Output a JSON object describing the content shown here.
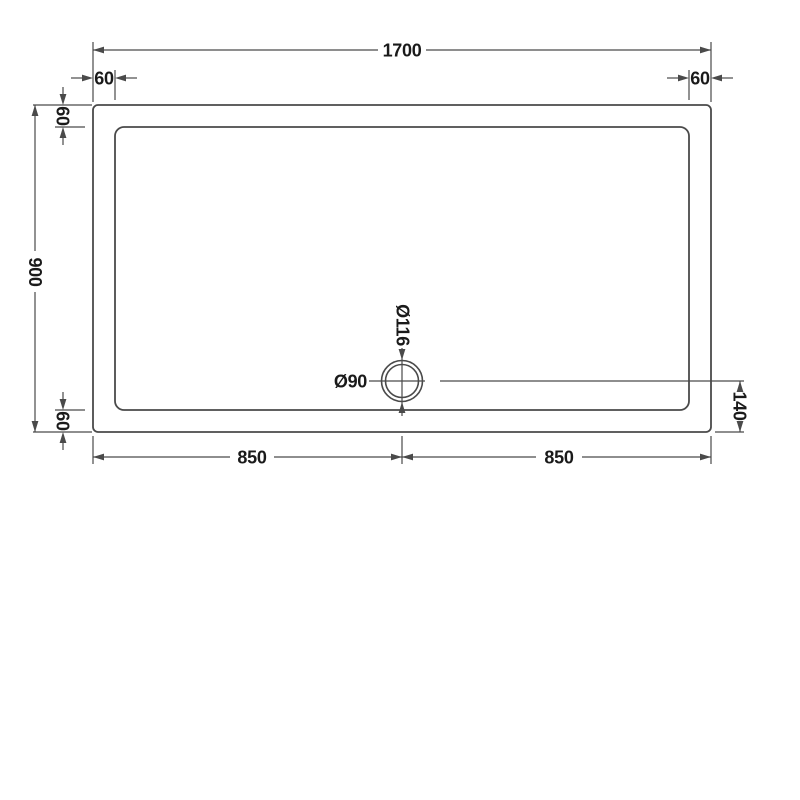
{
  "diagram": {
    "labels": {
      "overall_width": "1700",
      "overall_depth": "900",
      "inset_top_left": "60",
      "inset_top_right": "60",
      "inset_left_top": "60",
      "inset_left_bottom": "60",
      "waste_outer_diameter": "Ø116",
      "waste_inner_diameter": "Ø90",
      "waste_center_to_bottom_edge": "140",
      "half_width_left": "850",
      "half_width_right": "850"
    },
    "colors": {
      "line": "#4a4a4a",
      "text": "#1a1a1a",
      "background": "#ffffff"
    }
  }
}
